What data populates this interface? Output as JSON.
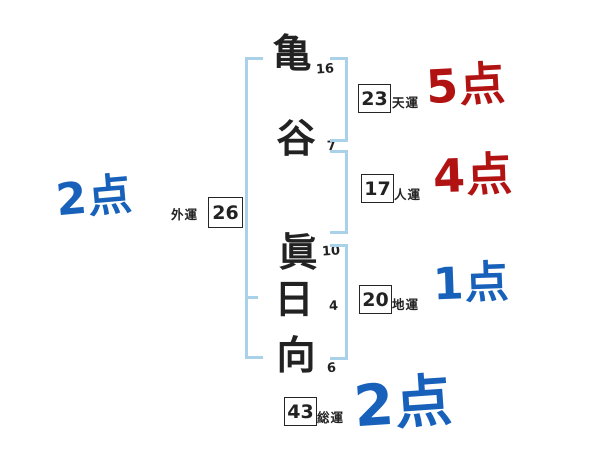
{
  "colors": {
    "score_blue": "#1861bb",
    "score_red": "#b11212",
    "bracket_blue": "#a9d2ea",
    "ink": "#222222"
  },
  "name": {
    "chars": [
      {
        "char": "亀",
        "strokes": "16"
      },
      {
        "char": "谷",
        "strokes": "7"
      },
      {
        "char": "眞",
        "strokes": "10"
      },
      {
        "char": "日",
        "strokes": "4"
      },
      {
        "char": "向",
        "strokes": "6"
      }
    ]
  },
  "fortunes": [
    {
      "id": "tenun",
      "label": "天運",
      "value": "23",
      "score": "5点",
      "score_color": "red"
    },
    {
      "id": "jinun",
      "label": "人運",
      "value": "17",
      "score": "4点",
      "score_color": "red"
    },
    {
      "id": "chiun",
      "label": "地運",
      "value": "20",
      "score": "1点",
      "score_color": "blue"
    },
    {
      "id": "soun",
      "label": "総運",
      "value": "43",
      "score": "2点",
      "score_color": "blue"
    },
    {
      "id": "gaiun",
      "label": "外運",
      "value": "26",
      "score": "2点",
      "score_color": "blue"
    }
  ]
}
